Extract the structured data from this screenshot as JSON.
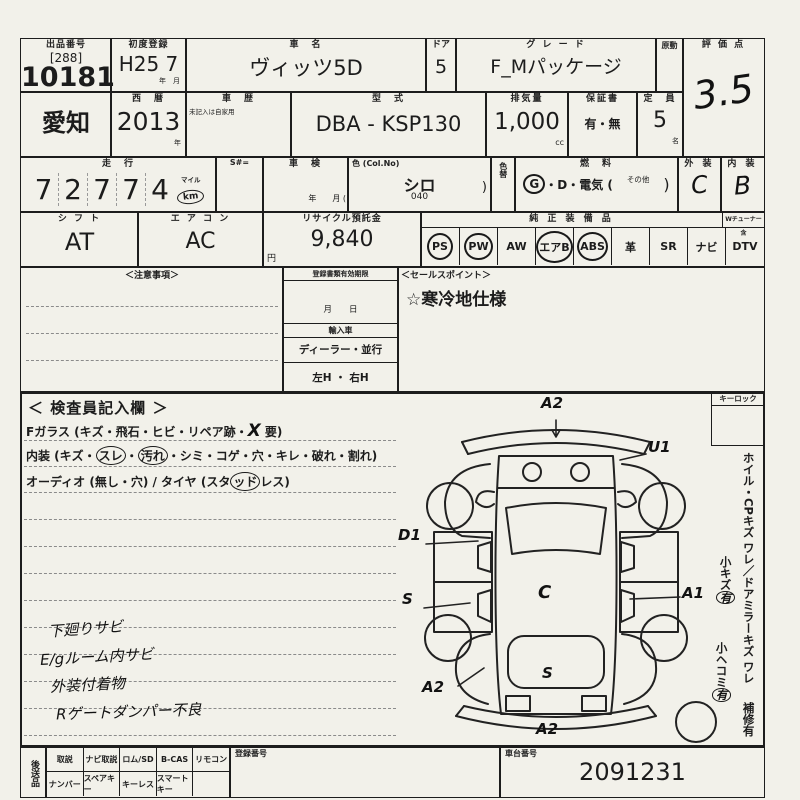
{
  "colors": {
    "paper": "#f2f1ea",
    "ink": "#1c1c1c"
  },
  "lot": {
    "header": "出品番号",
    "bracket": "[288]",
    "number": "10181"
  },
  "first_reg": {
    "header": "初度登録",
    "value": "H25 7",
    "units": "年　月"
  },
  "car_name": {
    "header": "車　名",
    "value": "ヴィッツ5D"
  },
  "door": {
    "header": "ドア",
    "value": "5"
  },
  "grade": {
    "header": "グ レ ー ド",
    "value": "F_Mパッケージ"
  },
  "engine_col": {
    "header": "原動"
  },
  "score": {
    "header": "評 価 点",
    "value": "3.5"
  },
  "prefecture": {
    "value": "愛知"
  },
  "year_west": {
    "header": "西　暦",
    "value": "2013",
    "unit": "年"
  },
  "history": {
    "header": "車　歴",
    "note": "未記入は自家用"
  },
  "model_code": {
    "header": "型　式",
    "value": "DBA - KSP130"
  },
  "displacement": {
    "header": "排気量",
    "value": "1,000",
    "unit": "cc"
  },
  "warranty": {
    "header": "保証書",
    "value": "有・無"
  },
  "capacity": {
    "header": "定　員",
    "value": "5",
    "unit": "名"
  },
  "mileage": {
    "header": "走　行",
    "digits": [
      "7",
      "2",
      "7",
      "7",
      "4"
    ],
    "unit_top": "マイル",
    "unit_bottom": "km"
  },
  "s_number": {
    "header": "S#="
  },
  "shaken": {
    "header": "車　検",
    "units": "年　　月 ("
  },
  "color": {
    "header": "色 (Col.No)",
    "value": "シロ",
    "code": "040",
    "paren": ")"
  },
  "color_change": {
    "header": "色替"
  },
  "fuel": {
    "header": "燃　料",
    "g": "G",
    "mid": "・D・電気 (",
    "other": "その他",
    "close": ")"
  },
  "exterior": {
    "header": "外 装",
    "value": "C"
  },
  "interior_grade": {
    "header": "内 装",
    "value": "B"
  },
  "shift": {
    "header": "シ フ ト",
    "value": "AT"
  },
  "aircon": {
    "header": "エ ア コ ン",
    "value": "AC"
  },
  "recycle": {
    "header": "リサイクル預託金",
    "value": "9,840",
    "unit": "円"
  },
  "equipment": {
    "header": "純 正 装 備 品",
    "tuner_header": "Wチューナー含",
    "items": [
      {
        "label": "PS",
        "circled": true
      },
      {
        "label": "PW",
        "circled": true
      },
      {
        "label": "AW",
        "circled": false
      },
      {
        "label": "エアB",
        "circled": true
      },
      {
        "label": "ABS",
        "circled": true
      },
      {
        "label": "革",
        "circled": false
      },
      {
        "label": "SR",
        "circled": false
      },
      {
        "label": "ナビ",
        "circled": false
      },
      {
        "label": "DTV",
        "circled": false
      }
    ]
  },
  "notice": {
    "header": "＜注意事項＞"
  },
  "docs": {
    "header": "登録書類有効期限",
    "date_units": "月　　日",
    "import_header": "輸入車",
    "import_row": "ディーラー・並行",
    "handle_row": "左H ・ 右H"
  },
  "sales_point": {
    "header": "＜セールスポイント＞",
    "value": "☆寒冷地仕様"
  },
  "inspector": {
    "title": "＜ 検査員記入欄 ＞",
    "glass_pre": "Fガラス (キズ・飛石・ヒビ・リペア跡・",
    "glass_mark": "X",
    "glass_post": "要)",
    "interior_pre": "内装 (キズ・",
    "interior_c1": "スレ",
    "interior_sep": "・",
    "interior_c2": "汚れ",
    "interior_post": "・シミ・コゲ・穴・キレ・破れ・割れ)",
    "audio_pre": "オーディオ (無し・穴) / タイヤ (スタ",
    "audio_circ": "ッド",
    "audio_post": "レス)",
    "notes": [
      "下廻りサビ",
      "E/gルーム内サビ",
      "外装付着物",
      "Rゲートダンパー不良"
    ]
  },
  "key_lock": {
    "header": "キーロック"
  },
  "right_rail": {
    "line1": "ホイル・CPキズ ワレ",
    "line2": "／ドアミラーキズ ワレ",
    "small_scratch": "小キズ",
    "small_scratch_mark": "有",
    "small_dent": "小ヘコミ",
    "small_dent_mark": "有",
    "repair": "補修有"
  },
  "diagram": {
    "marks": [
      "A2",
      "U1",
      "D1",
      "S",
      "C",
      "A1",
      "A2",
      "S",
      "A2"
    ]
  },
  "bottom": {
    "send_label": "後送品",
    "row1": [
      "取説",
      "ナビ取説",
      "ロム/SD",
      "B-CAS",
      "リモコン"
    ],
    "row2": [
      "ナンバー",
      "スペアキー",
      "キーレス",
      "スマートキー",
      ""
    ],
    "reg_header": "登録番号",
    "chassis_header": "車台番号",
    "chassis_value": "2091231"
  }
}
